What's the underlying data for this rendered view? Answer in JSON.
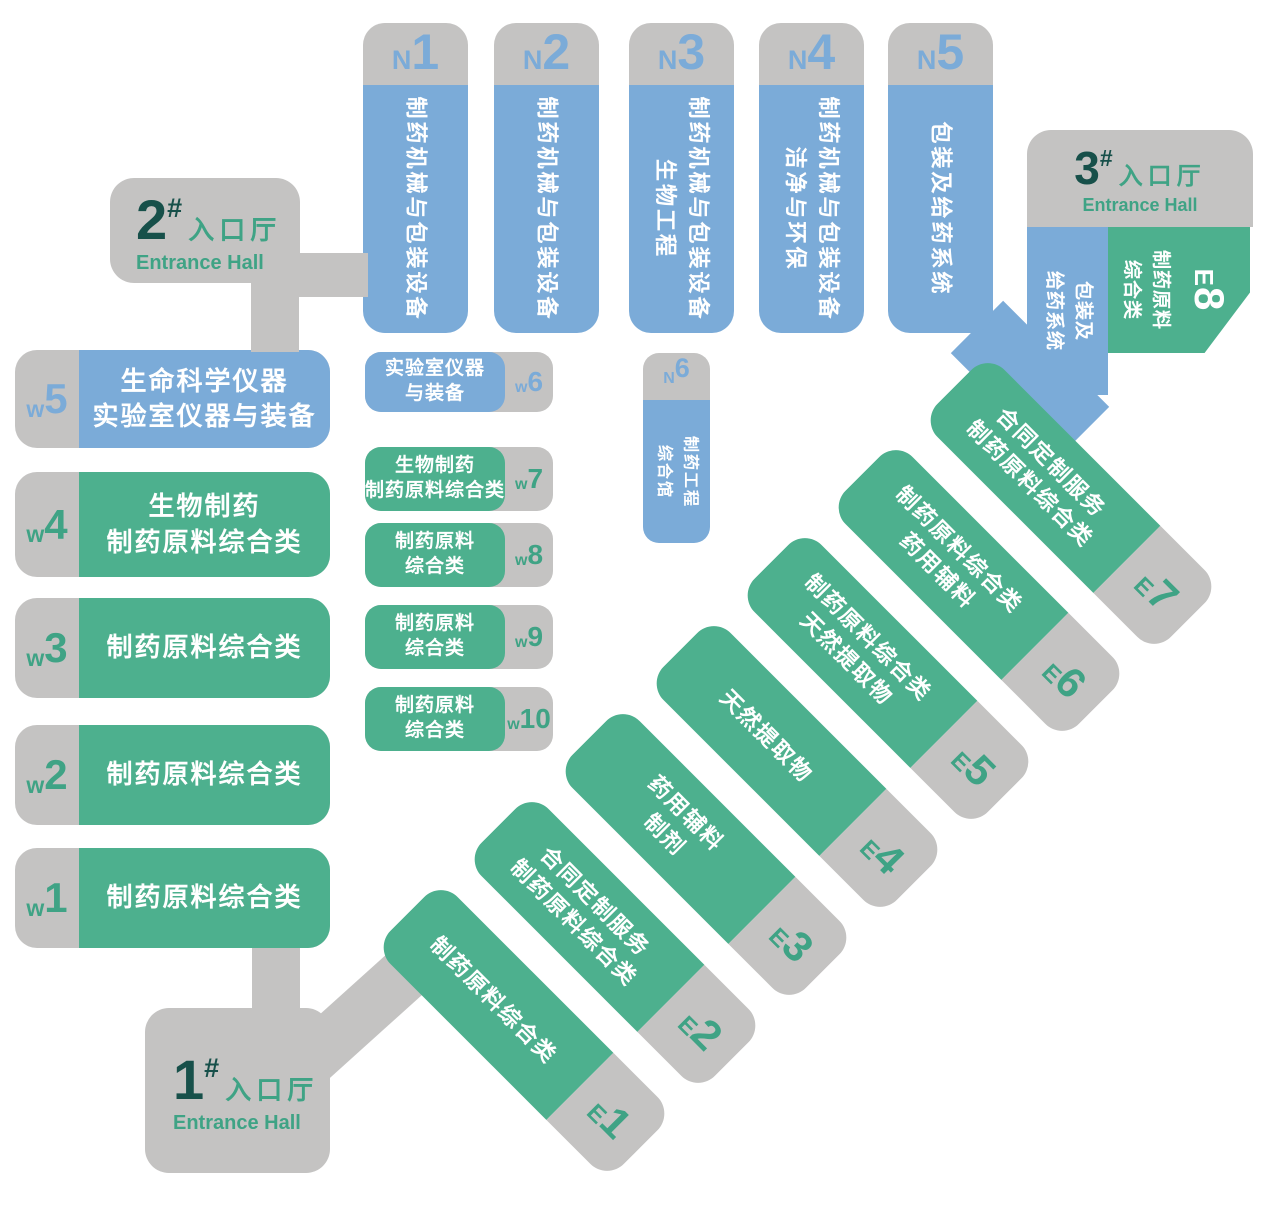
{
  "colors": {
    "blue": "#7babd8",
    "green": "#4db08e",
    "gray": "#c4c3c2",
    "dark_number": "#17504a",
    "green_text": "#3fa385",
    "hall_text": "#ffffff"
  },
  "north_halls": [
    {
      "id": "N1",
      "letter": "N",
      "num": "1",
      "lines": [
        "制药机械与包装设备",
        ""
      ]
    },
    {
      "id": "N2",
      "letter": "N",
      "num": "2",
      "lines": [
        "制药机械与包装设备",
        ""
      ]
    },
    {
      "id": "N3",
      "letter": "N",
      "num": "3",
      "lines": [
        "制药机械与包装设备",
        "生物工程"
      ]
    },
    {
      "id": "N4",
      "letter": "N",
      "num": "4",
      "lines": [
        "制药机械与包装设备",
        "洁净与环保"
      ]
    },
    {
      "id": "N5",
      "letter": "N",
      "num": "5",
      "lines": [
        "包装及给药系统",
        ""
      ]
    },
    {
      "id": "N6",
      "letter": "N",
      "num": "6",
      "lines": [
        "制药工程",
        "综合馆"
      ]
    }
  ],
  "west_halls": [
    {
      "id": "w1",
      "letter": "w",
      "num": "1",
      "lines": [
        "制药原料综合类",
        ""
      ]
    },
    {
      "id": "w2",
      "letter": "w",
      "num": "2",
      "lines": [
        "制药原料综合类",
        ""
      ]
    },
    {
      "id": "w3",
      "letter": "w",
      "num": "3",
      "lines": [
        "制药原料综合类",
        ""
      ]
    },
    {
      "id": "w4",
      "letter": "w",
      "num": "4",
      "lines": [
        "生物制药",
        "制药原料综合类"
      ]
    },
    {
      "id": "w5",
      "letter": "w",
      "num": "5",
      "lines": [
        "生命科学仪器",
        "实验室仪器与装备"
      ]
    },
    {
      "id": "w6",
      "letter": "w",
      "num": "6",
      "lines": [
        "实验室仪器",
        "与装备"
      ]
    },
    {
      "id": "w7",
      "letter": "w",
      "num": "7",
      "lines": [
        "生物制药",
        "制药原料综合类"
      ]
    },
    {
      "id": "w8",
      "letter": "w",
      "num": "8",
      "lines": [
        "制药原料",
        "综合类"
      ]
    },
    {
      "id": "w9",
      "letter": "w",
      "num": "9",
      "lines": [
        "制药原料",
        "综合类"
      ]
    },
    {
      "id": "w10",
      "letter": "w",
      "num": "10",
      "lines": [
        "制药原料",
        "综合类"
      ]
    }
  ],
  "east_halls": [
    {
      "id": "E1",
      "letter": "E",
      "num": "1",
      "lines": [
        "制药原料综合类",
        ""
      ]
    },
    {
      "id": "E2",
      "letter": "E",
      "num": "2",
      "lines": [
        "合同定制服务",
        "制药原料综合类"
      ]
    },
    {
      "id": "E3",
      "letter": "E",
      "num": "3",
      "lines": [
        "药用辅料",
        "制剂"
      ]
    },
    {
      "id": "E4",
      "letter": "E",
      "num": "4",
      "lines": [
        "天然提取物",
        ""
      ]
    },
    {
      "id": "E5",
      "letter": "E",
      "num": "5",
      "lines": [
        "制药原料综合类",
        "天然提取物"
      ]
    },
    {
      "id": "E6",
      "letter": "E",
      "num": "6",
      "lines": [
        "制药原料综合类",
        "药用辅料"
      ]
    },
    {
      "id": "E7",
      "letter": "E",
      "num": "7",
      "lines": [
        "合同定制服务",
        "制药原料综合类"
      ]
    },
    {
      "id": "E8",
      "letter": "E",
      "num": "8",
      "lines": [
        "制药原料",
        "综合类"
      ]
    }
  ],
  "packaging_wing": {
    "lines": [
      "包装及",
      "给药系统"
    ]
  },
  "entrances": [
    {
      "num": "1",
      "hash": "#",
      "cn": "入口厅",
      "en": "Entrance Hall"
    },
    {
      "num": "2",
      "hash": "#",
      "cn": "入口厅",
      "en": "Entrance Hall"
    },
    {
      "num": "3",
      "hash": "#",
      "cn": "入口厅",
      "en": "Entrance Hall"
    }
  ]
}
